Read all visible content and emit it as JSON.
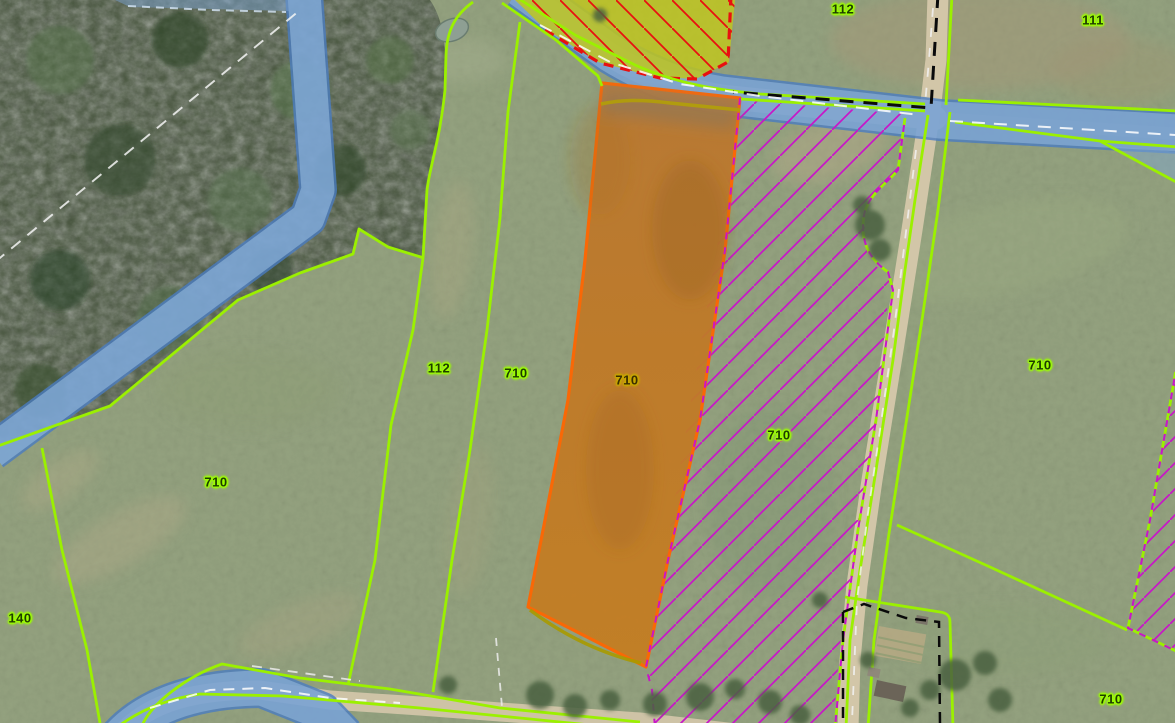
{
  "app": {
    "view_title": "aerial-cadastral-map-view"
  },
  "map": {
    "parcel_labels": [
      {
        "text": "112",
        "x": 843,
        "y": 9,
        "variant": "green"
      },
      {
        "text": "111",
        "x": 1093,
        "y": 20,
        "variant": "green"
      },
      {
        "text": "112",
        "x": 439,
        "y": 368,
        "variant": "green"
      },
      {
        "text": "710",
        "x": 516,
        "y": 373,
        "variant": "green"
      },
      {
        "text": "710",
        "x": 627,
        "y": 380,
        "variant": "olive"
      },
      {
        "text": "710",
        "x": 779,
        "y": 435,
        "variant": "green"
      },
      {
        "text": "710",
        "x": 1040,
        "y": 365,
        "variant": "green"
      },
      {
        "text": "710",
        "x": 216,
        "y": 482,
        "variant": "green"
      },
      {
        "text": "140",
        "x": 20,
        "y": 618,
        "variant": "green"
      },
      {
        "text": "710",
        "x": 1111,
        "y": 699,
        "variant": "green"
      }
    ],
    "colors": {
      "parcel_boundary": "#9BF000",
      "selected_parcel_outline": "#FF6600",
      "selected_parcel_fill": "#C07A28",
      "selected_parcel_accent": "#B3A008",
      "hatch_magenta": "#C816C8",
      "hatch_red": "#E81010",
      "water_overlay": "#7796BE",
      "water_edge": "#4A7CC0",
      "admin_boundary_black": "#0A0A0A",
      "cadastral_dash_white": "#F5F5F5",
      "road_surface": "#CEC3A6",
      "forest": "#46543C",
      "field": "#94A27F",
      "label_text": "#1E3C00",
      "label_halo": "#9DFF00"
    }
  }
}
